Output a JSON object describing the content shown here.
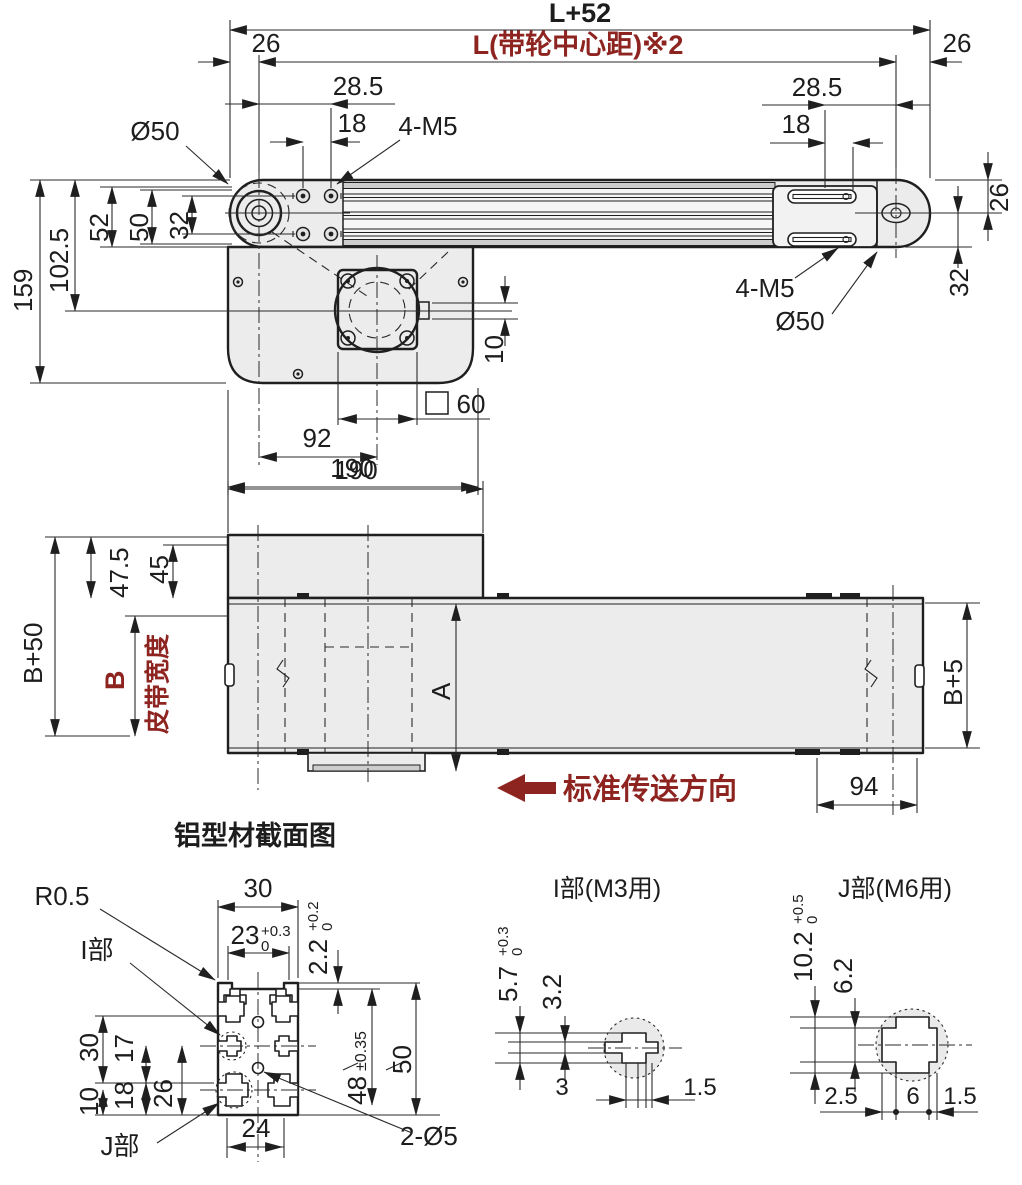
{
  "colors": {
    "accent_red": "#8e2420",
    "line": "#1f1f1f",
    "metal_fill": "#ececec"
  },
  "view_top": {
    "dim_overall": "L+52",
    "dim_pulley_centers": "L(带轮中心距)※2",
    "dim_26_left": "26",
    "dim_26_right": "26",
    "dim_285_left": "28.5",
    "dim_18_left": "18",
    "label_4m5_left": "4-M5",
    "label_d50_left": "Ø50",
    "dim_285_right": "28.5",
    "dim_18_right": "18",
    "label_4m5_right": "4-M5",
    "label_d50_right": "Ø50",
    "dim_159": "159",
    "dim_1025": "102.5",
    "dim_52": "52",
    "dim_50": "50",
    "dim_32": "32",
    "dim_26_vert_right": "26",
    "dim_32_vert_right": "32",
    "dim_10": "10",
    "dim_60": "60",
    "dim_92": "92",
    "dim_190": "190"
  },
  "view_side": {
    "dim_190": "190",
    "dim_475": "47.5",
    "dim_45": "45",
    "dim_b50": "B+50",
    "dim_b": "B",
    "dim_b_note": "皮带宽度",
    "dim_a": "A",
    "dim_b5": "B+5",
    "dim_94": "94",
    "direction_note": "标准传送方向"
  },
  "section": {
    "title": "铝型材截面图",
    "label_r05": "R0.5",
    "label_i": "I部",
    "label_j": "J部",
    "label_2d5": "2-Ø5",
    "dim_30_top": "30",
    "dim_23": {
      "base": "23",
      "tol_up": "+0.3",
      "tol_dn": "0"
    },
    "dim_22": {
      "base": "2.2",
      "tol_up": "+0.2",
      "tol_dn": "0"
    },
    "dim_48": {
      "base": "48",
      "tol": "±0.35"
    },
    "dim_50_right": "50",
    "dim_30_left": "30",
    "dim_10_left": "10",
    "dim_17": "17",
    "dim_18": "18",
    "dim_26": "26",
    "dim_24": "24"
  },
  "detail_i": {
    "title": "I部(M3用)",
    "dim_57": {
      "base": "5.7",
      "tol_up": "+0.3",
      "tol_dn": "0"
    },
    "dim_32": "3.2",
    "dim_3": "3",
    "dim_15": "1.5"
  },
  "detail_j": {
    "title": "J部(M6用)",
    "dim_102": {
      "base": "10.2",
      "tol_up": "+0.5",
      "tol_dn": "0"
    },
    "dim_62": "6.2",
    "dim_25": "2.5",
    "dim_6": "6",
    "dim_15": "1.5"
  }
}
